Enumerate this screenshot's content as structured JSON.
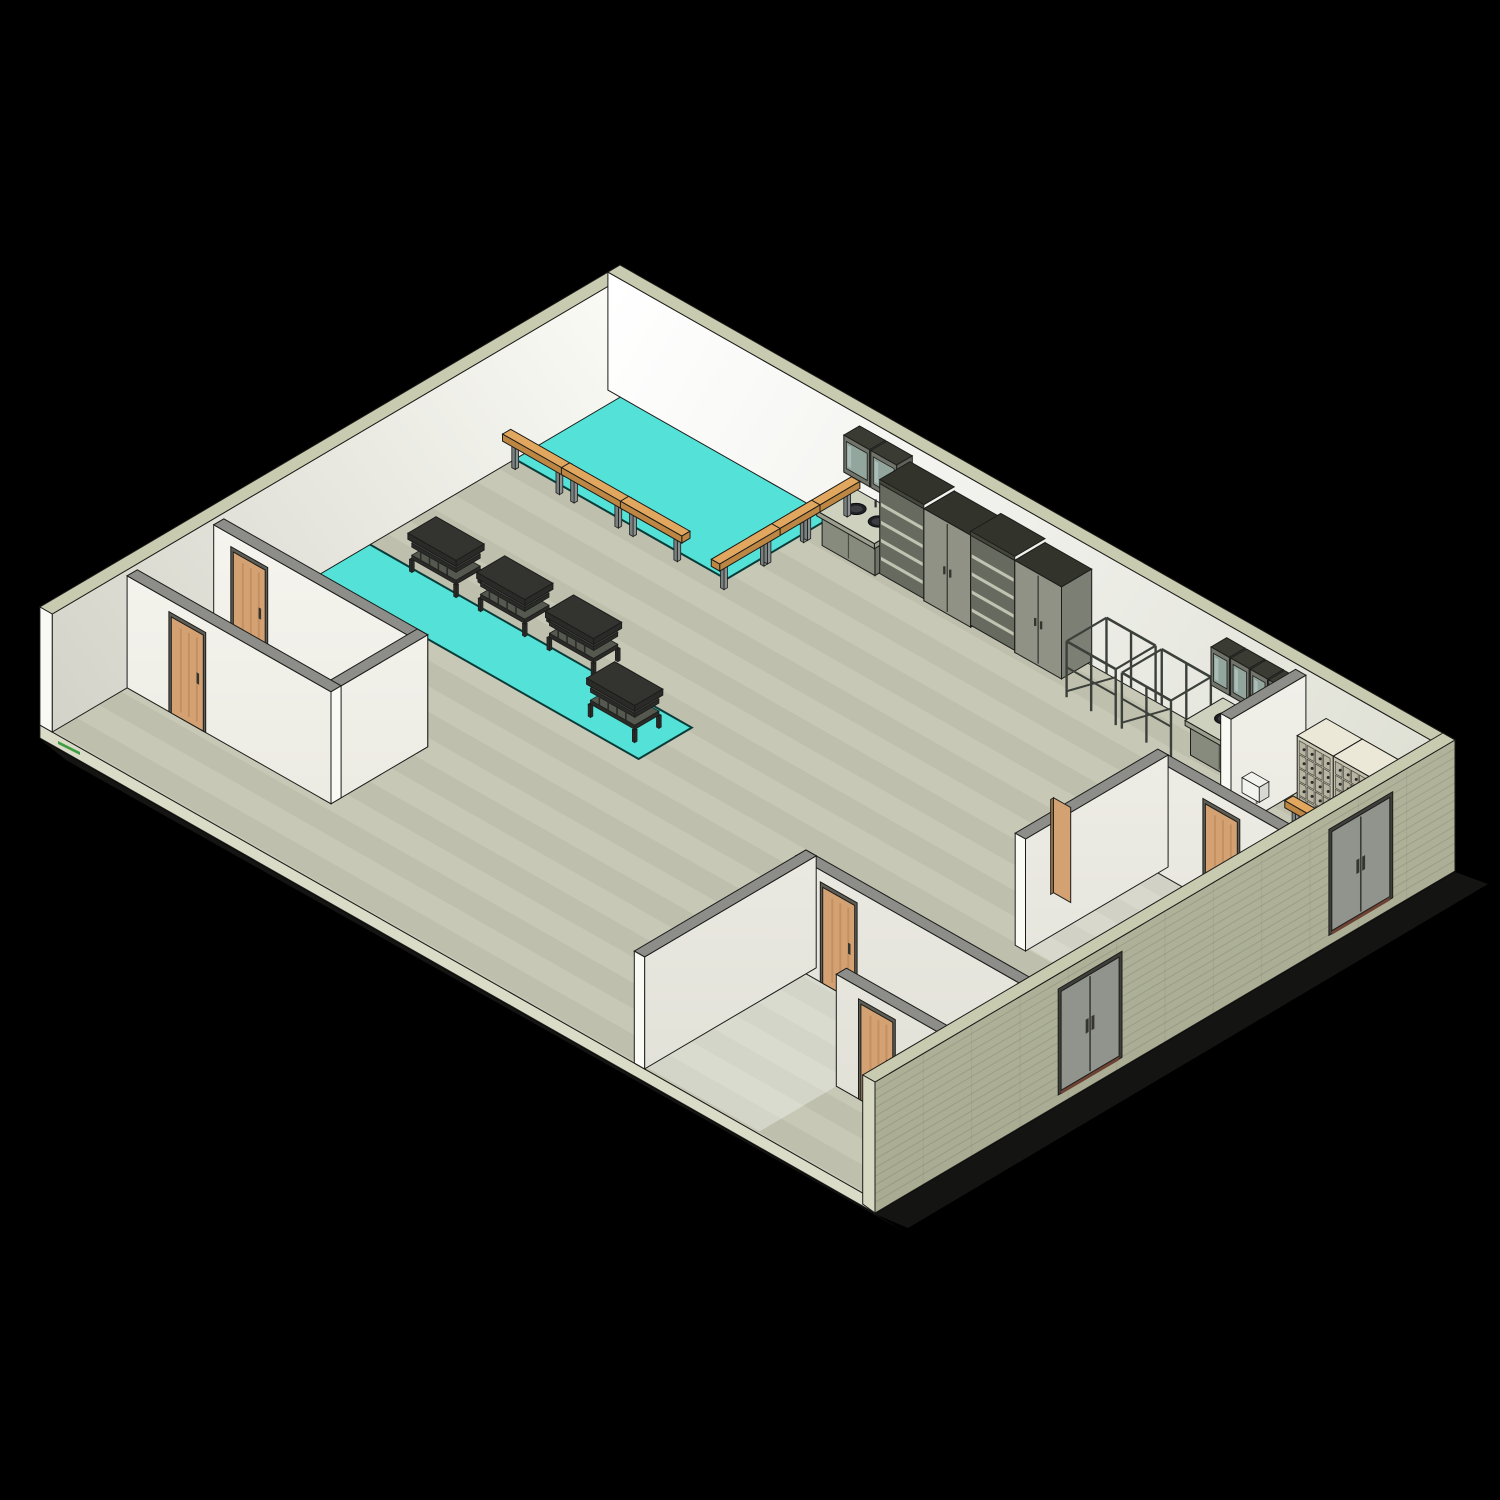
{
  "meta": {
    "view_type": "isometric 3D architectural BIM render",
    "content": "cutaway axonometric view of a gym / locker-room floor plan on black background"
  },
  "scene": {
    "background": "#000000",
    "palette": {
      "outline": "#1c1c1a",
      "floor": "#c7c9b6",
      "floorBand": "rgba(70,75,50,0.07)",
      "slabEdge": "#dadcc8",
      "groundShadow": "#141412",
      "wallNWTop": "#fbfbf6",
      "wallNWBottom": "#d3d3c9",
      "wallNETop": "#ffffff",
      "wallNEBottom": "#dedfd3",
      "extWallCap": "#c9cbb0",
      "extWallLight": "#d6d8c2",
      "extWall": "#b4b79e",
      "extWallDark": "#a5a88f",
      "extWallCourse": "rgba(0,0,0,0.10)",
      "partitionCap": "#8d8d8a",
      "partitionFaceTop": "#f6f5ef",
      "partitionFaceBottom": "#e2e1d8",
      "partitionEnd": "#fafaf5",
      "matCyan": "#54e1d7",
      "matOutline": "#093c39",
      "roomGlow": "#ffffff",
      "woodDoor": "#d4a173",
      "woodDoorGrain": "rgba(140,80,25,0.25)",
      "doorFrame": "#5d5d55",
      "doorHandle": "#35352f",
      "grayDoor": "#90948d",
      "grayDoorFrame": "#3e3f3a",
      "threshold": "#6e4233",
      "benchTop": "#e2a75e",
      "benchSide": "#bd8743",
      "benchLeg": "#9aa0a0",
      "rackFrame": "#2a2b28",
      "rackShelf": "#55584f",
      "cabinetFront": "#8f9285",
      "cabinetSide": "#7c7f73",
      "cabinetTop": "#32342c",
      "shelfInterior": "#676a5e",
      "shelfEdge": "#c0c3b2",
      "counterBase": "#878b7d",
      "counterSide": "#6f7267",
      "counterTop": "#cfd1bf",
      "sinkBasin": "#1f2024",
      "sinkInner": "#3c3e42",
      "glassPane": "#93a69e",
      "glassLight": "#b9cdc6",
      "wallCabFrame": "#70746a",
      "pipeRack": "#3c403b",
      "lockerFace": "#c6c3af",
      "lockerDoor": "#b7b4a1",
      "lockerTop": "#ebe8d8",
      "lockerSide": "#a9a694",
      "lockerKnob": "#2b2b27",
      "dispenser": "#f2f2ee",
      "dispenserArm": "#6f6f6a",
      "greenMark": "#3f9d43"
    },
    "inventory": {
      "rooms": [
        "main-hall",
        "left-room",
        "bottom-center-room",
        "right-room",
        "small-room-se",
        "locker-room"
      ],
      "gym_mats": 2,
      "benches_large_mat": 6,
      "bench_locker_room": 1,
      "shoe_racks_on_strip": 4,
      "tall_open_shelves": 2,
      "tall_double_door_cabinets": 2,
      "sink_counters": 2,
      "sink_basins": 3,
      "glass_wall_cabinets": 6,
      "pipe_garment_racks": 2,
      "locker_sections": 3,
      "locker_compartments": 60,
      "wood_doors": 6,
      "exterior_double_doors": 2,
      "wall_dispenser": 1
    }
  }
}
